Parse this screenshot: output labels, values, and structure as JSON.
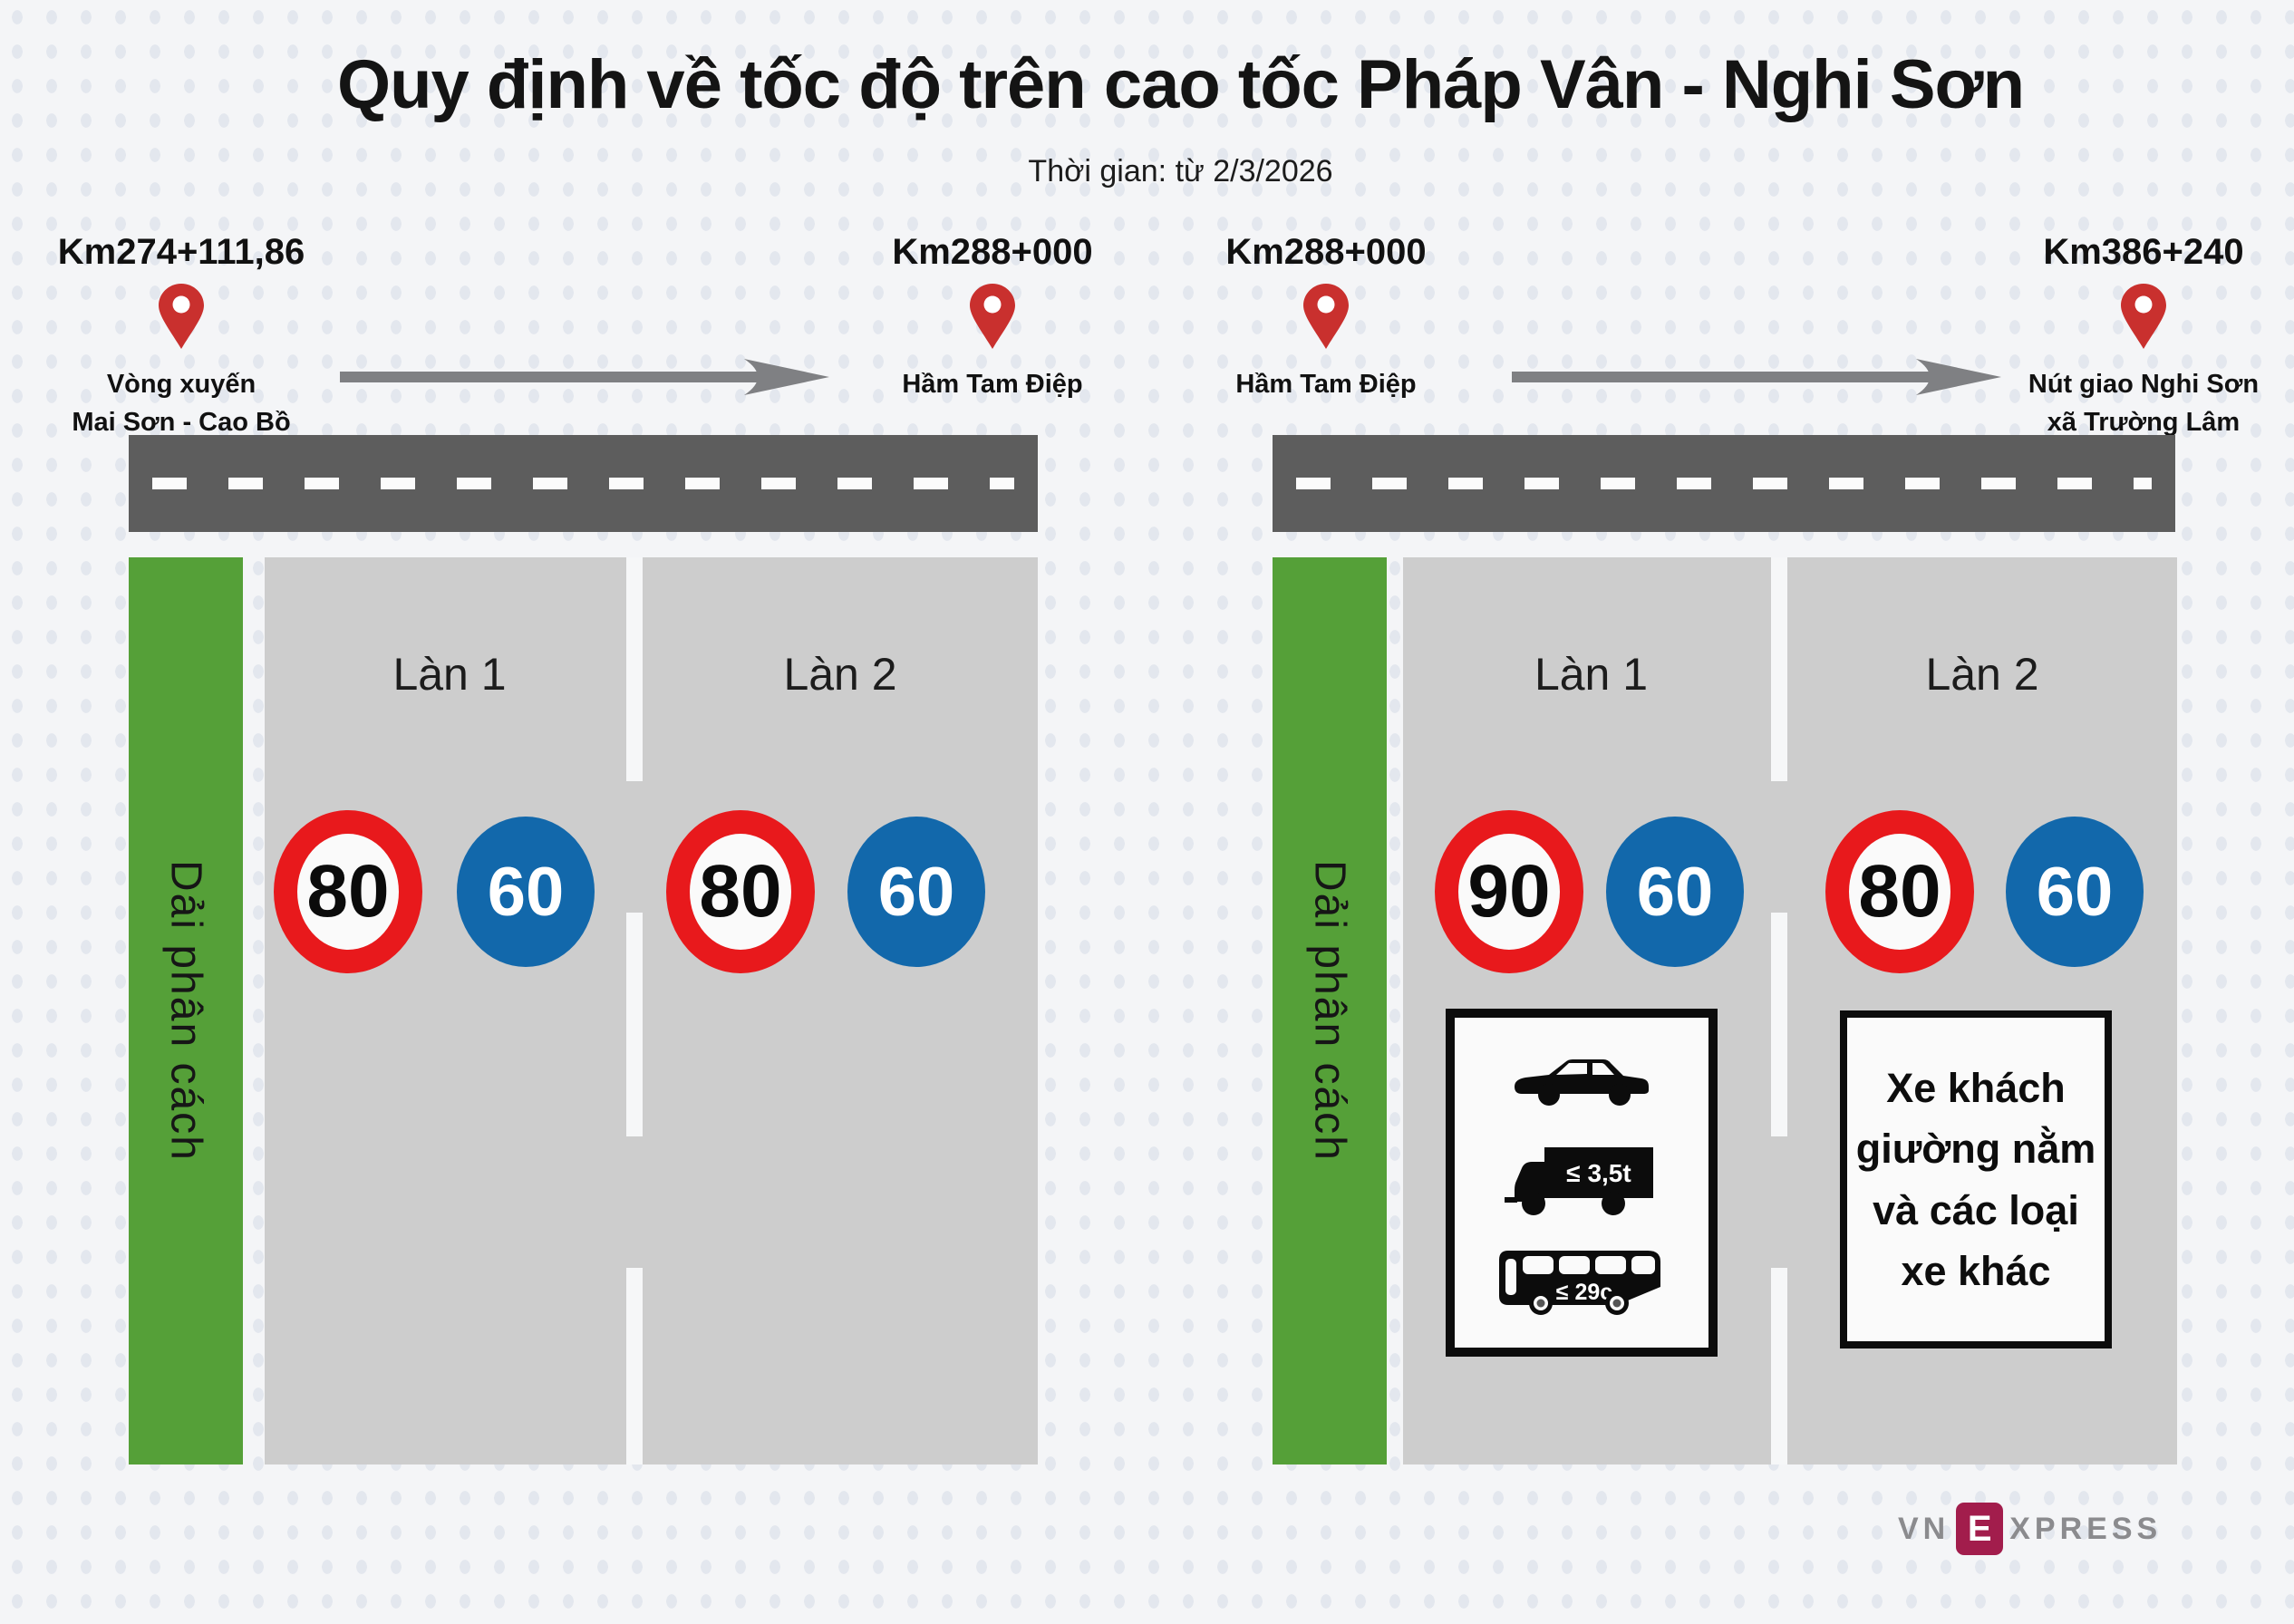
{
  "title": "Quy định về tốc độ trên cao tốc Pháp Vân - Nghi Sơn",
  "subtitle": "Thời gian: từ 2/3/2026",
  "markers": [
    {
      "km": "Km274+111,86",
      "line1": "Vòng xuyến",
      "line2": "Mai Sơn - Cao Bồ"
    },
    {
      "km": "Km288+000",
      "line1": "Hầm Tam Điệp",
      "line2": ""
    },
    {
      "km": "Km288+000",
      "line1": "Hầm Tam Điệp",
      "line2": ""
    },
    {
      "km": "Km386+240",
      "line1": "Nút giao Nghi Sơn",
      "line2": "xã Trường Lâm"
    }
  ],
  "sections": [
    {
      "median_label": "Dải phân cách",
      "lanes": [
        {
          "name": "Làn 1",
          "max_speed": "80",
          "min_speed": "60"
        },
        {
          "name": "Làn 2",
          "max_speed": "80",
          "min_speed": "60"
        }
      ]
    },
    {
      "median_label": "Dải phân cách",
      "lanes": [
        {
          "name": "Làn 1",
          "max_speed": "90",
          "min_speed": "60"
        },
        {
          "name": "Làn 2",
          "max_speed": "80",
          "min_speed": "60"
        }
      ],
      "vehicle_sign": {
        "truck_limit": "≤ 3,5t",
        "bus_limit": "≤ 29c"
      },
      "note_sign": {
        "line1": "Xe khách",
        "line2": "giường nằm",
        "line3": "và các loại",
        "line4": "xe khác"
      }
    }
  ],
  "logo": {
    "vn": "VN",
    "e": "E",
    "xpress": "XPRESS"
  },
  "colors": {
    "background": "#f4f5f7",
    "median_green": "#55a038",
    "road_gray": "#5d5d5d",
    "lane_gray": "#cdcdcd",
    "sign_red": "#e8191c",
    "sign_blue": "#1268ab",
    "pin_red": "#c9302e",
    "logo_maroon": "#a21d4c"
  }
}
